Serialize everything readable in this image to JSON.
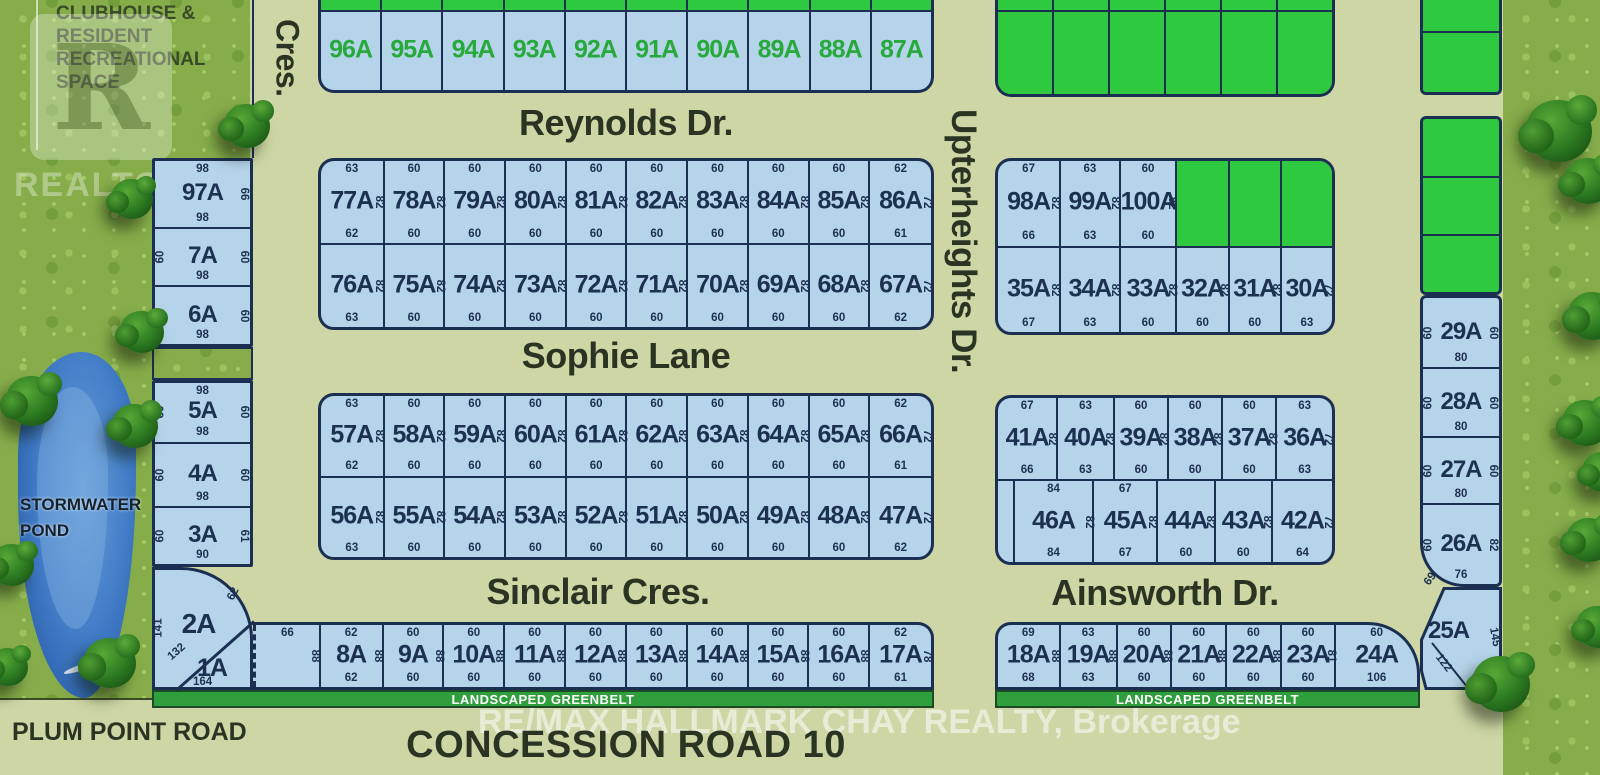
{
  "annotations": {
    "clubhouse_lines": [
      "CLUBHOUSE &",
      "RESIDENT",
      "RECREATIONAL",
      "SPACE"
    ],
    "stormwater_line1": "STORMWATER",
    "stormwater_line2": "POND",
    "plum_point_road": "PLUM POINT ROAD",
    "concession_road": "CONCESSION ROAD 10",
    "landscaped_greenbelt": "LANDSCAPED GREENBELT",
    "watermark_realtor_letter": "R",
    "watermark_realtor_word": "REALTOR",
    "watermark_realtor_reg": "®",
    "watermark_remax": "RE/MAX HALLMARK CHAY REALTY, Brokerage"
  },
  "streets": {
    "cres": "Cres.",
    "reynolds": "Reynolds Dr.",
    "sophie": "Sophie Lane",
    "sinclair": "Sinclair Cres.",
    "upterheights": "Upterheights Dr.",
    "ainsworth": "Ainsworth Dr."
  },
  "colors": {
    "lot_blue": "#b5d3e9",
    "lot_green": "#2fc93f",
    "greenbelt": "#2f9e3c",
    "line_navy": "#1b2f52",
    "label_navy": "#1c3050",
    "label_green": "#28a93c",
    "road_tan": "#cdd6a4",
    "street_text": "#2b3423"
  },
  "lot_rows": {
    "reynolds_top": {
      "green_labels": true,
      "cells": [
        {
          "label": "96A",
          "w": 60
        },
        {
          "label": "95A",
          "w": 60
        },
        {
          "label": "94A",
          "w": 60
        },
        {
          "label": "93A",
          "w": 60
        },
        {
          "label": "92A",
          "w": 60
        },
        {
          "label": "91A",
          "w": 60
        },
        {
          "label": "90A",
          "w": 60
        },
        {
          "label": "89A",
          "w": 60
        },
        {
          "label": "88A",
          "w": 60
        },
        {
          "label": "87A",
          "w": 60
        }
      ]
    },
    "row_77": {
      "cells": [
        {
          "label": "77A",
          "top": "63",
          "bottom": "62",
          "side": "82",
          "w": 63
        },
        {
          "label": "78A",
          "top": "60",
          "bottom": "60",
          "side": "82",
          "w": 60
        },
        {
          "label": "79A",
          "top": "60",
          "bottom": "60",
          "side": "82",
          "w": 60
        },
        {
          "label": "80A",
          "top": "60",
          "bottom": "60",
          "side": "82",
          "w": 60
        },
        {
          "label": "81A",
          "top": "60",
          "bottom": "60",
          "side": "82",
          "w": 60
        },
        {
          "label": "82A",
          "top": "60",
          "bottom": "60",
          "side": "82",
          "w": 60
        },
        {
          "label": "83A",
          "top": "60",
          "bottom": "60",
          "side": "82",
          "w": 60
        },
        {
          "label": "84A",
          "top": "60",
          "bottom": "60",
          "side": "82",
          "w": 60
        },
        {
          "label": "85A",
          "top": "60",
          "bottom": "60",
          "side": "82",
          "w": 60
        },
        {
          "label": "86A",
          "top": "62",
          "bottom": "61",
          "side": "72",
          "w": 62
        }
      ]
    },
    "row_76": {
      "cells": [
        {
          "label": "76A",
          "bottom": "63",
          "side": "82",
          "w": 63
        },
        {
          "label": "75A",
          "bottom": "60",
          "side": "82",
          "w": 60
        },
        {
          "label": "74A",
          "bottom": "60",
          "side": "82",
          "w": 60
        },
        {
          "label": "73A",
          "bottom": "60",
          "side": "82",
          "w": 60
        },
        {
          "label": "72A",
          "bottom": "60",
          "side": "82",
          "w": 60
        },
        {
          "label": "71A",
          "bottom": "60",
          "side": "82",
          "w": 60
        },
        {
          "label": "70A",
          "bottom": "60",
          "side": "82",
          "w": 60
        },
        {
          "label": "69A",
          "bottom": "60",
          "side": "82",
          "w": 60
        },
        {
          "label": "68A",
          "bottom": "60",
          "side": "82",
          "w": 60
        },
        {
          "label": "67A",
          "bottom": "62",
          "side": "72",
          "w": 62
        }
      ]
    },
    "row_57": {
      "cells": [
        {
          "label": "57A",
          "top": "63",
          "bottom": "62",
          "side": "82",
          "w": 63
        },
        {
          "label": "58A",
          "top": "60",
          "bottom": "60",
          "side": "82",
          "w": 60
        },
        {
          "label": "59A",
          "top": "60",
          "bottom": "60",
          "side": "82",
          "w": 60
        },
        {
          "label": "60A",
          "top": "60",
          "bottom": "60",
          "side": "82",
          "w": 60
        },
        {
          "label": "61A",
          "top": "60",
          "bottom": "60",
          "side": "82",
          "w": 60
        },
        {
          "label": "62A",
          "top": "60",
          "bottom": "60",
          "side": "82",
          "w": 60
        },
        {
          "label": "63A",
          "top": "60",
          "bottom": "60",
          "side": "82",
          "w": 60
        },
        {
          "label": "64A",
          "top": "60",
          "bottom": "60",
          "side": "82",
          "w": 60
        },
        {
          "label": "65A",
          "top": "60",
          "bottom": "60",
          "side": "82",
          "w": 60
        },
        {
          "label": "66A",
          "top": "62",
          "bottom": "61",
          "side": "72",
          "w": 62
        }
      ]
    },
    "row_56": {
      "cells": [
        {
          "label": "56A",
          "bottom": "63",
          "side": "82",
          "w": 63
        },
        {
          "label": "55A",
          "bottom": "60",
          "side": "82",
          "w": 60
        },
        {
          "label": "54A",
          "bottom": "60",
          "side": "82",
          "w": 60
        },
        {
          "label": "53A",
          "bottom": "60",
          "side": "82",
          "w": 60
        },
        {
          "label": "52A",
          "bottom": "60",
          "side": "82",
          "w": 60
        },
        {
          "label": "51A",
          "bottom": "60",
          "side": "82",
          "w": 60
        },
        {
          "label": "50A",
          "bottom": "60",
          "side": "82",
          "w": 60
        },
        {
          "label": "49A",
          "bottom": "60",
          "side": "82",
          "w": 60
        },
        {
          "label": "48A",
          "bottom": "60",
          "side": "82",
          "w": 60
        },
        {
          "label": "47A",
          "bottom": "62",
          "side": "72",
          "w": 62
        }
      ]
    },
    "row_bottom_left": {
      "cells": [
        {
          "top": "66",
          "side": "88",
          "w": 64,
          "dashedLeft": true
        },
        {
          "label": "8A",
          "top": "62",
          "bottom": "62",
          "side": "88",
          "w": 62
        },
        {
          "label": "9A",
          "top": "60",
          "bottom": "60",
          "side": "88",
          "w": 60
        },
        {
          "label": "10A",
          "top": "60",
          "bottom": "60",
          "side": "88",
          "w": 60
        },
        {
          "label": "11A",
          "top": "60",
          "bottom": "60",
          "side": "88",
          "w": 60
        },
        {
          "label": "12A",
          "top": "60",
          "bottom": "60",
          "side": "88",
          "w": 60
        },
        {
          "label": "13A",
          "top": "60",
          "bottom": "60",
          "side": "88",
          "w": 60
        },
        {
          "label": "14A",
          "top": "60",
          "bottom": "60",
          "side": "88",
          "w": 60
        },
        {
          "label": "15A",
          "top": "60",
          "bottom": "60",
          "side": "88",
          "w": 60
        },
        {
          "label": "16A",
          "top": "60",
          "bottom": "60",
          "side": "88",
          "w": 60
        },
        {
          "label": "17A",
          "top": "62",
          "bottom": "61",
          "side": "78",
          "w": 62
        }
      ]
    },
    "right_top_green": {
      "cells": [
        {
          "green": true,
          "w": 60
        },
        {
          "green": true,
          "w": 60
        },
        {
          "green": true,
          "w": 60
        },
        {
          "green": true,
          "w": 60
        },
        {
          "green": true,
          "w": 60
        },
        {
          "green": true,
          "w": 60
        }
      ]
    },
    "row_98": {
      "cells": [
        {
          "label": "98A",
          "top": "67",
          "bottom": "66",
          "side": "82",
          "w": 67
        },
        {
          "label": "99A",
          "top": "63",
          "bottom": "63",
          "side": "82",
          "w": 63
        },
        {
          "label": "100A",
          "top": "60",
          "bottom": "60",
          "side": "82",
          "w": 60
        },
        {
          "green": true,
          "w": 55
        },
        {
          "green": true,
          "w": 55
        },
        {
          "green": true,
          "w": 55
        }
      ]
    },
    "row_35": {
      "cells": [
        {
          "label": "35A",
          "bottom": "67",
          "side": "82",
          "w": 67
        },
        {
          "label": "34A",
          "bottom": "63",
          "side": "82",
          "w": 63
        },
        {
          "label": "33A",
          "bottom": "60",
          "side": "82",
          "w": 60
        },
        {
          "label": "32A",
          "bottom": "60",
          "side": "82",
          "w": 55
        },
        {
          "label": "31A",
          "bottom": "60",
          "side": "82",
          "w": 55
        },
        {
          "label": "30A",
          "bottom": "63",
          "side": "72",
          "w": 55
        }
      ]
    },
    "row_41": {
      "cells": [
        {
          "label": "41A",
          "top": "67",
          "bottom": "66",
          "side": "82",
          "w": 67
        },
        {
          "label": "40A",
          "top": "63",
          "bottom": "63",
          "side": "82",
          "w": 63
        },
        {
          "label": "39A",
          "top": "60",
          "bottom": "60",
          "side": "82",
          "w": 60
        },
        {
          "label": "38A",
          "top": "60",
          "bottom": "60",
          "side": "82",
          "w": 60
        },
        {
          "label": "37A",
          "top": "60",
          "bottom": "60",
          "side": "82",
          "w": 60
        },
        {
          "label": "36A",
          "top": "63",
          "bottom": "63",
          "side": "72",
          "w": 63
        }
      ]
    },
    "row_46": {
      "cells": [
        {
          "w": 16
        },
        {
          "label": "46A",
          "top": "84",
          "bottom": "84",
          "side": "82",
          "w": 84
        },
        {
          "label": "45A",
          "top": "67",
          "bottom": "67",
          "side": "82",
          "w": 67
        },
        {
          "label": "44A",
          "bottom": "60",
          "side": "82",
          "w": 60
        },
        {
          "label": "43A",
          "bottom": "60",
          "side": "82",
          "w": 60
        },
        {
          "label": "42A",
          "bottom": "64",
          "side": "72",
          "w": 64
        }
      ]
    },
    "row_18": {
      "cells": [
        {
          "label": "18A",
          "top": "69",
          "bottom": "68",
          "side": "88",
          "w": 69
        },
        {
          "label": "19A",
          "top": "63",
          "bottom": "63",
          "side": "88",
          "w": 63
        },
        {
          "label": "20A",
          "top": "60",
          "bottom": "60",
          "side": "88",
          "w": 60
        },
        {
          "label": "21A",
          "top": "60",
          "bottom": "60",
          "side": "88",
          "w": 60
        },
        {
          "label": "22A",
          "top": "60",
          "bottom": "60",
          "side": "88",
          "w": 60
        },
        {
          "label": "23A",
          "top": "60",
          "bottom": "60",
          "side": "81",
          "w": 60
        },
        {
          "label": "24A",
          "top": "60",
          "bottom": "106",
          "w": 92
        }
      ]
    }
  },
  "columns": {
    "left_top": {
      "cells": [
        {
          "label": "97A",
          "top": "98",
          "bottom": "98",
          "right": "66",
          "h": 70
        },
        {
          "label": "7A",
          "left": "60",
          "right": "60",
          "bottom": "98",
          "h": 59
        },
        {
          "label": "6A",
          "left": "60",
          "right": "60",
          "bottom": "98",
          "h": 60
        }
      ]
    },
    "left_bottom": {
      "cells": [
        {
          "label": "5A",
          "top": "98",
          "left": "60",
          "right": "60",
          "bottom": "98",
          "h": 62
        },
        {
          "label": "4A",
          "left": "60",
          "right": "60",
          "bottom": "98",
          "h": 66
        },
        {
          "label": "3A",
          "left": "60",
          "right": "61",
          "bottom": "90",
          "h": 59
        }
      ]
    },
    "right_blue": {
      "cells": [
        {
          "label": "29A",
          "left": "60",
          "right": "60",
          "bottom": "80",
          "h": 72
        },
        {
          "label": "28A",
          "left": "60",
          "right": "60",
          "bottom": "80",
          "h": 70
        },
        {
          "label": "27A",
          "left": "60",
          "right": "60",
          "bottom": "80",
          "h": 68
        },
        {
          "label": "26A",
          "left": "60",
          "right": "82",
          "bottom": "76",
          "h": 82
        }
      ]
    },
    "fr_green_1": {
      "cells": [
        {
          "green": true,
          "h": 33
        },
        {
          "green": true,
          "h": 62
        }
      ]
    },
    "fr_green_2": {
      "cells": [
        {
          "green": true,
          "h": 60
        },
        {
          "green": true,
          "h": 60
        },
        {
          "green": true,
          "h": 59
        }
      ]
    }
  },
  "corner": {
    "lot2_label": "2A",
    "dim_141": "141",
    "dim_132": "132",
    "dim_62": "62",
    "lot1_label": "1A",
    "dim_164": "164",
    "lot25_label": "25A",
    "dim_145": "145",
    "dim_122": "122",
    "dim_35": "35",
    "dim_69": "69"
  }
}
